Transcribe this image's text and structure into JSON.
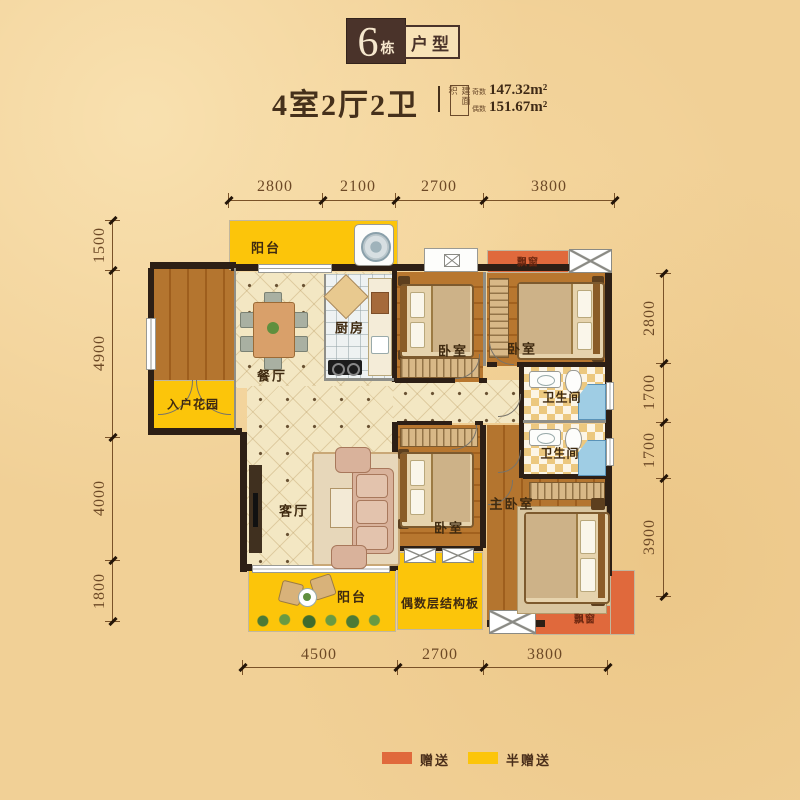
{
  "header": {
    "badge_number": "6",
    "badge_unit": "栋",
    "badge_type": "户型",
    "title": "4室2厅2卫",
    "area_box_label": "建面积",
    "area1_prefix": "奇数",
    "area1_value": "147.32m²",
    "area2_prefix": "偶数",
    "area2_value": "151.67m²"
  },
  "dims": {
    "top": [
      "2800",
      "2100",
      "2700",
      "3800"
    ],
    "left": [
      "1500",
      "4900",
      "4000",
      "1800"
    ],
    "right": [
      "2800",
      "1700",
      "1700",
      "3900"
    ],
    "bottom": [
      "4500",
      "2700",
      "3800"
    ]
  },
  "rooms": {
    "balcony_top": "阳台",
    "entry_garden": "入户花园",
    "dining": "餐厅",
    "kitchen": "厨房",
    "bedroom_a": "卧室",
    "bedroom_b": "卧室",
    "bay_top": "飘窗",
    "bath_a": "卫生间",
    "bath_b": "卫生间",
    "living": "客厅",
    "balcony_bottom": "阳台",
    "bedroom_c": "卧室",
    "slab": "偶数层结构板",
    "master": "主卧室",
    "bay_bottom": "飘窗"
  },
  "legend": {
    "gift": "赠送",
    "half_gift": "半赠送"
  },
  "colors": {
    "gift": "#e0693c",
    "half_gift": "#fcc50a",
    "wall": "#2d1f15",
    "background": "#f1d096",
    "text": "#45301b"
  }
}
